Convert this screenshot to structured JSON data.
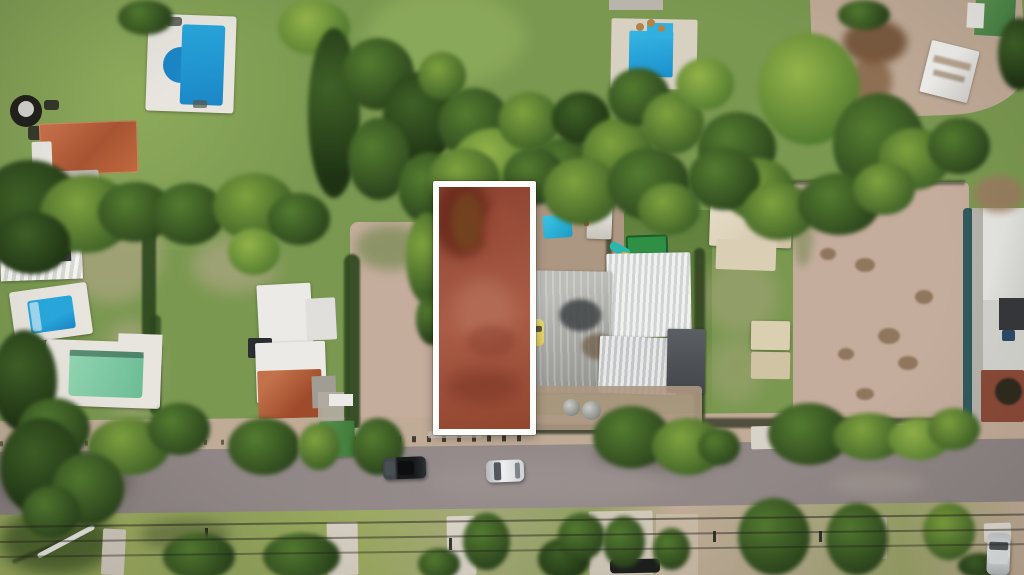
{
  "scene": {
    "type": "aerial-drone-photograph",
    "description": "Top-down drone photo of a suburban block: a vacant rectangular parcel is highlighted with a white outline and red tint, surrounded by houses with swimming pools, bare dirt lots, corrugated metal roofs, dense trees, and a paved street with parked cars along the bottom.",
    "highlighted_lot": {
      "outline_color": "#fdfdfb",
      "tint_dark": "#6f2f20",
      "tint_mid": "#9c4f3a",
      "tint_light": "#b4705a",
      "shape": "tall vertical rectangle"
    },
    "palette": {
      "grass1": "#7a9850",
      "grass2": "#8fac5c",
      "grass3": "#5f7f3c",
      "grassYellow": "#9aa95e",
      "treeDark": "#2c451d",
      "treeMid": "#3f6127",
      "treeGreen": "#547c30",
      "treeLight": "#7fa23f",
      "treeLime": "#94b34a",
      "dirt1": "#c0ab97",
      "dirt2": "#ac9782",
      "dirtPink": "#c5ad9d",
      "road1": "#8e8584",
      "road2": "#9e9594",
      "deck": "#e8e5df",
      "roofWhite": "#eceae6",
      "roofRed": "#a85432",
      "roofCream": "#ded3bb",
      "roofSlate": "#55585c",
      "poolBlue": "#28a7dc",
      "poolBlueDeep": "#1b86c6",
      "poolGreen": "#7fc8a5",
      "tarpBlue": "#25b2d8",
      "trampGreen": "#2f8f45",
      "shedGreen": "#4d8748",
      "fenceTeal": "#29555c",
      "lotBorder": "#fdfdfb",
      "carDark": "#23272a",
      "carSilver": "#d8dcde",
      "carYellow": "#e3cf63",
      "wire": "#232220"
    },
    "objects": [
      "blue-swimming-pool",
      "l-shaped-pool",
      "small-blue-pool",
      "green-pool",
      "terracotta-roof-house",
      "white-roof-house",
      "corrugated-metal-roofs",
      "blue-tarp",
      "green-trampoline",
      "playground-slide",
      "yellow-car",
      "dark-suv",
      "silver-sedan",
      "driveway-car",
      "asphalt-street",
      "power-lines",
      "utility-poles",
      "street-trees",
      "bare-dirt-lot",
      "teal-fence",
      "cream-roof-building",
      "hot-tub",
      "fallen-white-pole",
      "concrete-sidewalk-pads",
      "fire-pit",
      "water-tanks",
      "highlighted-vacant-lot"
    ]
  }
}
